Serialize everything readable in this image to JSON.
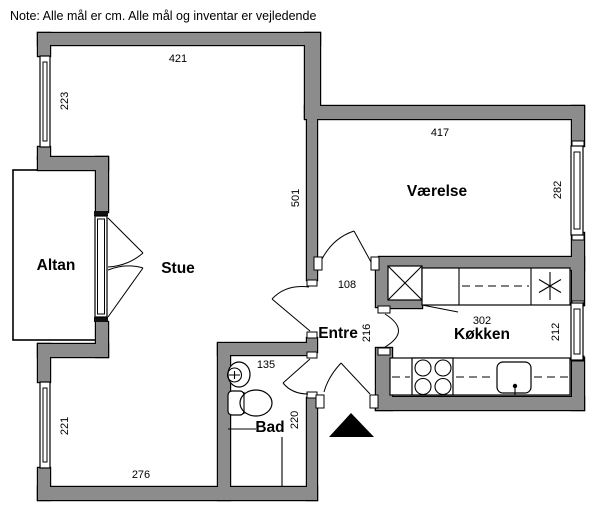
{
  "note": "Note: Alle mål er cm. Alle mål og inventar er vejledende",
  "rooms": {
    "altan": "Altan",
    "stue": "Stue",
    "vaerelse": "Værelse",
    "entre": "Entre",
    "koekken": "Køkken",
    "bad": "Bad"
  },
  "dims": {
    "stue_width_top": "421",
    "window_left_upper": "223",
    "stue_depth": "501",
    "vaerelse_width": "417",
    "vaerelse_depth": "282",
    "entre_opening": "108",
    "entre_depth": "216",
    "koekken_width": "302",
    "koekken_depth": "212",
    "bad_width": "135",
    "bad_depth": "220",
    "window_left_lower": "221",
    "stue_width_bottom": "276"
  },
  "symbols": {
    "shaft_box": "x-crossed-box",
    "freezer_asterisk": "✳",
    "stove": "four-burner-rings",
    "kitchen_sink": "basin-with-tap",
    "washbasin": "oval-basin-with-tap",
    "toilet": "toilet-top-view",
    "entrance_marker": "black-triangle"
  },
  "colors": {
    "wall_fill": "#8c8c8c",
    "wall_outline": "#000000",
    "background": "#ffffff",
    "entrance_marker": "#000000"
  }
}
